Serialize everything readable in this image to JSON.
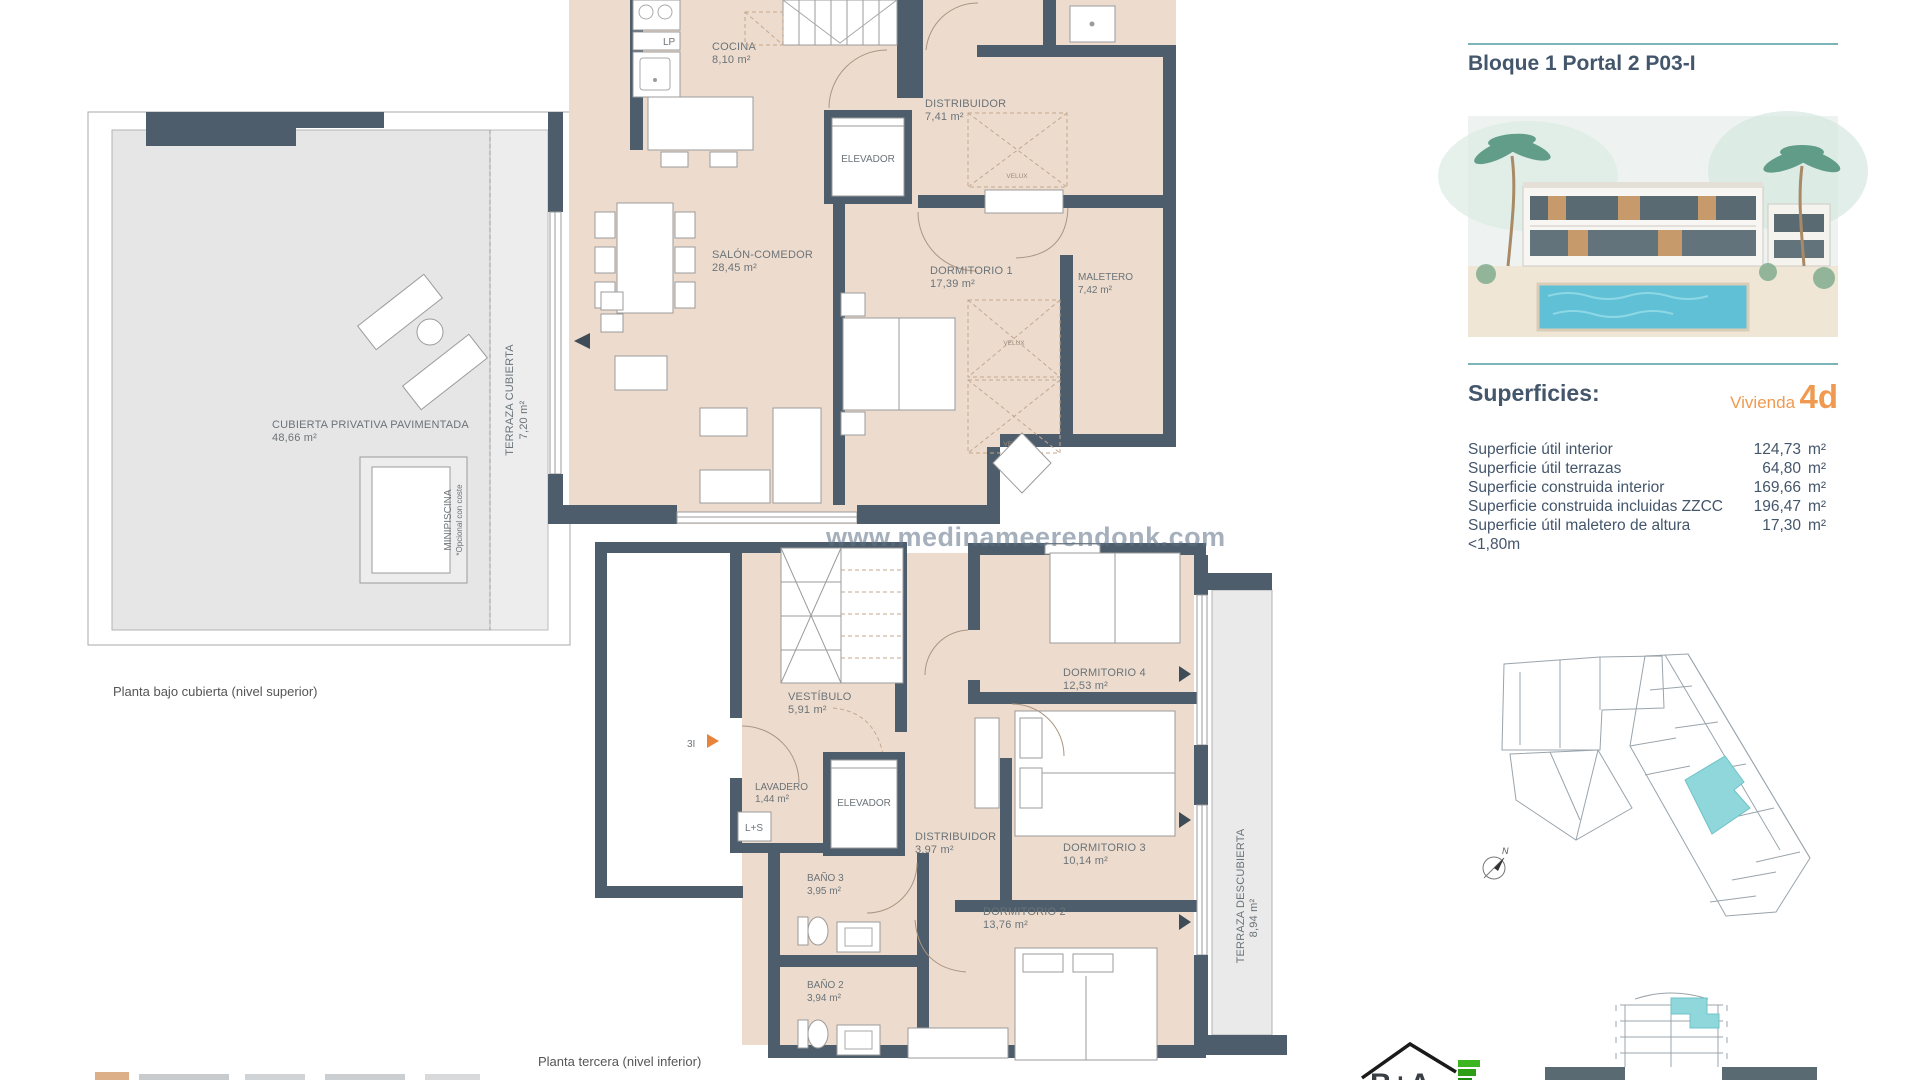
{
  "header": {
    "title": "Bloque 1 Portal 2 P03-I"
  },
  "superficies": {
    "heading": "Superficies:",
    "vivienda_label": "Vivienda",
    "vivienda_code": "4d",
    "rows": [
      {
        "label": "Superficie útil interior",
        "value": "124,73",
        "unit": "m²"
      },
      {
        "label": "Superficie útil terrazas",
        "value": "64,80",
        "unit": "m²"
      },
      {
        "label": "Superficie construida interior",
        "value": "169,66",
        "unit": "m²"
      },
      {
        "label": "Superficie construida incluidas ZZCC",
        "value": "196,47",
        "unit": "m²"
      },
      {
        "label": "Superficie útil maletero de altura <1,80m",
        "value": "17,30",
        "unit": "m²"
      }
    ]
  },
  "upper_plan": {
    "caption": "Planta bajo cubierta (nivel superior)",
    "rooms": {
      "cocina": {
        "name": "COCINA",
        "area": "8,10 m²"
      },
      "salon": {
        "name": "SALÓN-COMEDOR",
        "area": "28,45 m²"
      },
      "distribuidor": {
        "name": "DISTRIBUIDOR",
        "area": "7,41 m²"
      },
      "dormitorio1": {
        "name": "DORMITORIO 1",
        "area": "17,39 m²"
      },
      "maletero": {
        "name": "MALETERO",
        "area": "7,42 m²"
      },
      "terraza_cubierta": {
        "name": "TERRAZA CUBIERTA",
        "area": "7,20 m²"
      },
      "cubierta": {
        "name": "CUBIERTA PRIVATIVA PAVIMENTADA",
        "area": "48,66 m²"
      },
      "minipiscina": {
        "name": "MINIPISCINA",
        "note": "*Opcional con coste"
      },
      "elevador": "ELEVADOR",
      "lp": "LP",
      "velux": "VELUX"
    }
  },
  "lower_plan": {
    "caption": "Planta tercera (nivel inferior)",
    "marker": "3I",
    "rooms": {
      "vestibulo": {
        "name": "VESTÍBULO",
        "area": "5,91 m²"
      },
      "lavadero": {
        "name": "LAVADERO",
        "area": "1,44 m²"
      },
      "ls": "L+S",
      "elevador": "ELEVADOR",
      "distribuidor": {
        "name": "DISTRIBUIDOR",
        "area": "3,97 m²"
      },
      "bano3": {
        "name": "BAÑO 3",
        "area": "3,95 m²"
      },
      "bano2": {
        "name": "BAÑO 2",
        "area": "3,94 m²"
      },
      "dormitorio2": {
        "name": "DORMITORIO 2",
        "area": "13,76 m²"
      },
      "dormitorio3": {
        "name": "DORMITORIO 3",
        "area": "10,14 m²"
      },
      "dormitorio4": {
        "name": "DORMITORIO 4",
        "area": "12,53 m²"
      },
      "terraza_descubierta": {
        "name": "TERRAZA DESCUBIERTA",
        "area": "8,94 m²"
      }
    }
  },
  "watermark": "www.medinameerendonk.com",
  "compass": {
    "north": "N"
  },
  "colors": {
    "wall": "#4d5d6b",
    "room": "#eddcce",
    "terrace": "#e6e6e6",
    "accent_teal": "#7db4ba",
    "accent_orange": "#ef9a50",
    "highlight": "#8fd7da",
    "text": "#44566b"
  }
}
